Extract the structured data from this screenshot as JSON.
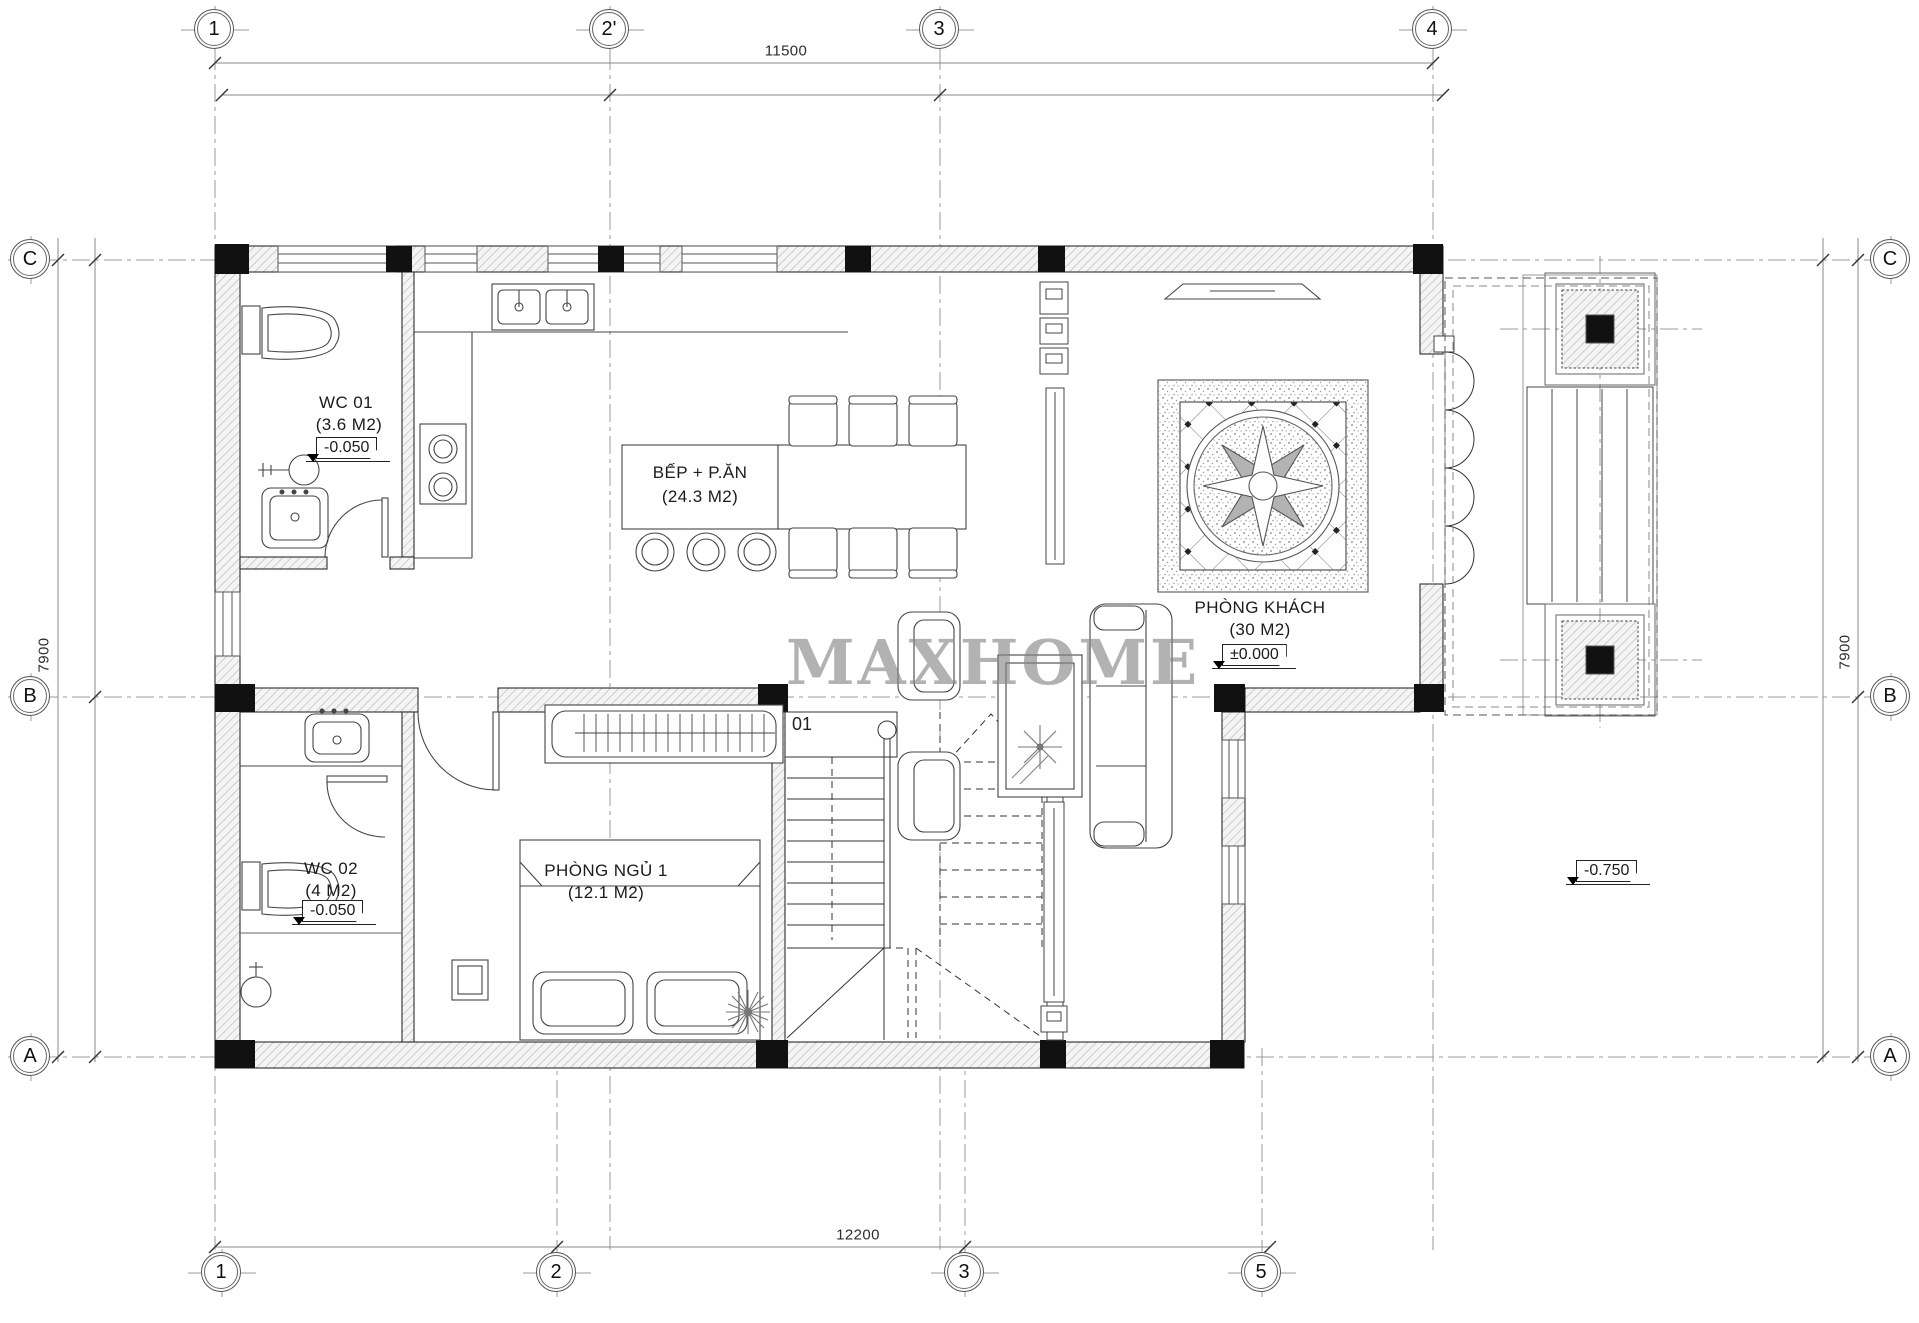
{
  "watermark": "MAXHOME",
  "grid_bubbles": {
    "top": [
      "1",
      "2'",
      "3",
      "4"
    ],
    "bottom": [
      "1",
      "2",
      "3",
      "5"
    ],
    "left": [
      "C",
      "B",
      "A"
    ],
    "right": [
      "C",
      "B",
      "A"
    ]
  },
  "dimensions": {
    "top": "11500",
    "bottom": "12200",
    "left": "7900",
    "right": "7900"
  },
  "rooms": {
    "wc1": {
      "name": "WC 01",
      "area": "(3.6 M2)",
      "level": "-0.050"
    },
    "kitchen_dining": {
      "name": "BẾP + P.ĂN",
      "area": "(24.3 M2)"
    },
    "living": {
      "name": "PHÒNG KHÁCH",
      "area": "(30 M2)",
      "level": "±0.000"
    },
    "wc2": {
      "name": "WC 02",
      "area": "(4 M2)",
      "level": "-0.050"
    },
    "bedroom": {
      "name": "PHÒNG NGỦ 1",
      "area": "(12.1 M2)"
    },
    "stair": {
      "label": "01"
    },
    "exterior": {
      "level": "-0.750"
    }
  },
  "colors": {
    "wall_hatch": "#b5b5b5",
    "column": "#111111",
    "grid": "#9a9a9a",
    "watermark": "#828282"
  }
}
